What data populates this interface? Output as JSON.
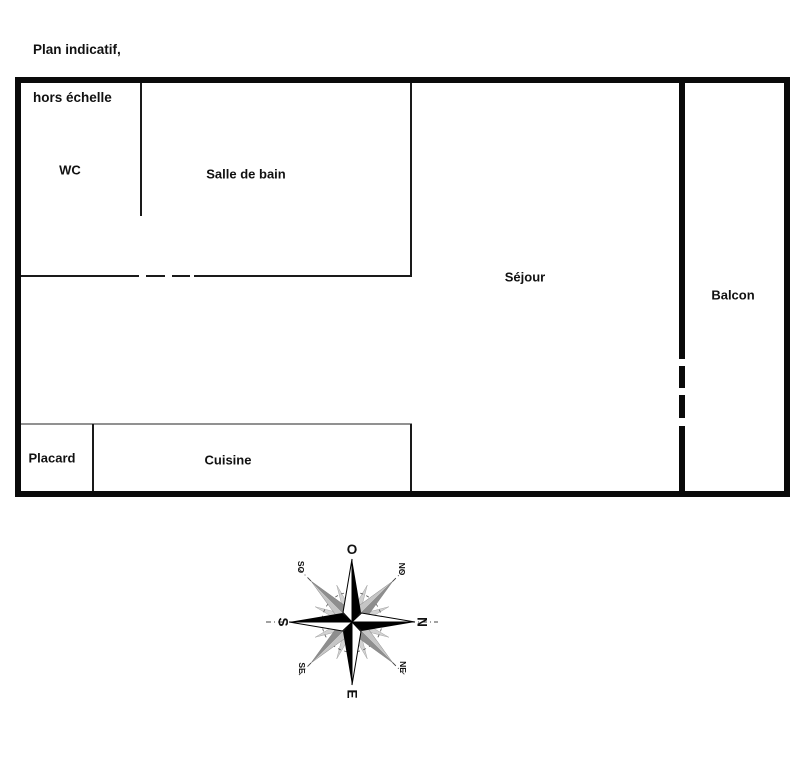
{
  "header": {
    "line1": "Plan indicatif,",
    "line2": "hors échelle"
  },
  "rooms": {
    "wc": "WC",
    "salle_de_bain": "Salle de bain",
    "sejour": "Séjour",
    "balcon": "Balcon",
    "placard": "Placard",
    "cuisine": "Cuisine"
  },
  "compass": {
    "west": "O",
    "north": "N",
    "south": "S",
    "east": "E",
    "northwest": "NO",
    "southwest": "SO",
    "northeast": "NE",
    "southeast": "SE"
  },
  "colors": {
    "wall": "#000000",
    "partition": "#1a1a1a",
    "cuisine_top_line": "#919191"
  }
}
